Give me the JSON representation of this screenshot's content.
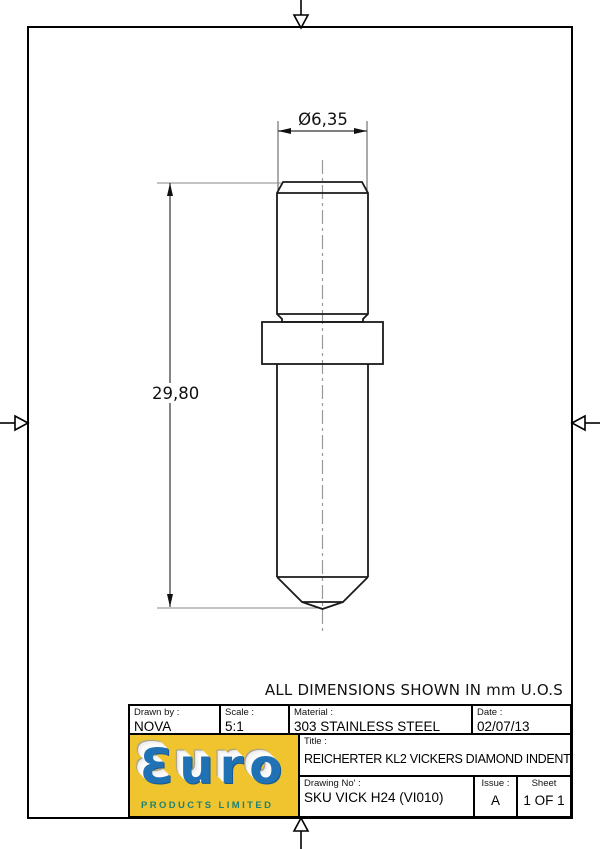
{
  "frame": {
    "note": "ALL DIMENSIONS SHOWN IN mm U.O.S"
  },
  "dimensions": {
    "diameter_label": "Ø6,35",
    "length_label": "29,80"
  },
  "title_block": {
    "drawn_by": {
      "label": "Drawn by :",
      "value": "NOVA"
    },
    "scale": {
      "label": "Scale :",
      "value": "5:1"
    },
    "material": {
      "label": "Material :",
      "value": "303 STAINLESS STEEL"
    },
    "date": {
      "label": "Date :",
      "value": "02/07/13"
    },
    "title": {
      "label": "Title :",
      "value": "REICHERTER KL2 VICKERS DIAMOND INDENTER"
    },
    "drawing_no": {
      "label": "Drawing No' :",
      "value": "SKU VICK H24 (VI010)"
    },
    "issue": {
      "label": "Issue :",
      "value": "A"
    },
    "sheet": {
      "label": "Sheet",
      "value": "1 OF 1"
    }
  },
  "logo": {
    "brand": "Ɛuro",
    "tagline": "PRODUCTS LIMITED",
    "colors": {
      "background": "#F0C42E",
      "brand_blue": "#2171B5",
      "tagline_teal": "#1E8173"
    }
  }
}
